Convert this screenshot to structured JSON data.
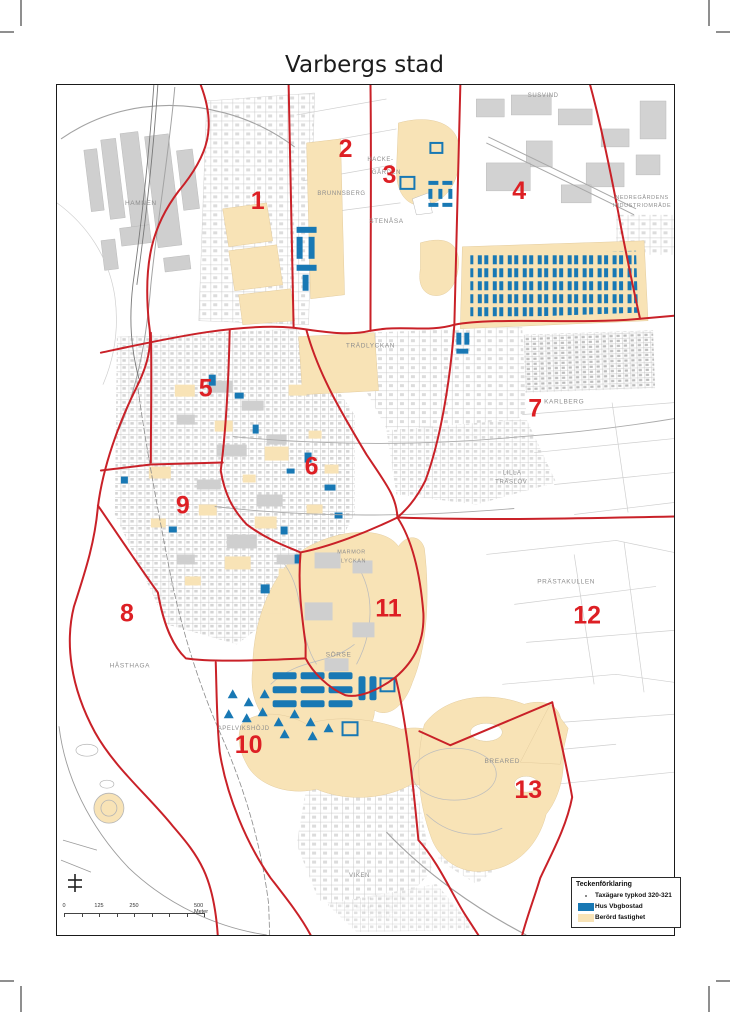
{
  "title": "Varbergs stad",
  "legend": {
    "title": "Teckenförklaring",
    "items": [
      {
        "label": "Taxägare typkod 320-321",
        "symbol": "dot"
      },
      {
        "label": "Hus Vbgbostad",
        "symbol": "blue"
      },
      {
        "label": "Berörd fastighet",
        "symbol": "beige"
      }
    ]
  },
  "scale_bar": {
    "labels": [
      {
        "text": "0",
        "x": 0
      },
      {
        "text": "125",
        "x": 35
      },
      {
        "text": "250",
        "x": 70
      },
      {
        "text": "500 Meter",
        "x": 140
      }
    ]
  },
  "districts": [
    {
      "label": "1",
      "x": 201,
      "y": 124
    },
    {
      "label": "2",
      "x": 289,
      "y": 72
    },
    {
      "label": "3",
      "x": 333,
      "y": 98
    },
    {
      "label": "4",
      "x": 463,
      "y": 114
    },
    {
      "label": "5",
      "x": 149,
      "y": 312
    },
    {
      "label": "6",
      "x": 255,
      "y": 390
    },
    {
      "label": "7",
      "x": 479,
      "y": 332
    },
    {
      "label": "8",
      "x": 70,
      "y": 537
    },
    {
      "label": "9",
      "x": 126,
      "y": 429
    },
    {
      "label": "10",
      "x": 192,
      "y": 669
    },
    {
      "label": "11",
      "x": 332,
      "y": 532
    },
    {
      "label": "12",
      "x": 531,
      "y": 539
    },
    {
      "label": "13",
      "x": 472,
      "y": 714
    }
  ],
  "place_labels": [
    {
      "text": "HAMNEN",
      "x": 84,
      "y": 120,
      "size": 6.5
    },
    {
      "text": "SUSVIND",
      "x": 487,
      "y": 12,
      "size": 6
    },
    {
      "text": "BRUNNSBERG",
      "x": 285,
      "y": 110,
      "size": 6
    },
    {
      "text": "HACKE-",
      "x": 324,
      "y": 76,
      "size": 6
    },
    {
      "text": "GÅRDEN",
      "x": 330,
      "y": 89,
      "size": 6
    },
    {
      "text": "STENÅSA",
      "x": 330,
      "y": 138,
      "size": 6.5
    },
    {
      "text": "NEDREGÅRDENS",
      "x": 586,
      "y": 114,
      "size": 5.5
    },
    {
      "text": "INDUSTRIOMRÅDE",
      "x": 586,
      "y": 122,
      "size": 5.5
    },
    {
      "text": "TRÄDLYCKAN",
      "x": 314,
      "y": 263,
      "size": 6.5
    },
    {
      "text": "KARLBERG",
      "x": 508,
      "y": 319,
      "size": 6.5
    },
    {
      "text": "LILLA",
      "x": 456,
      "y": 390,
      "size": 6
    },
    {
      "text": "TRÄSLÖV",
      "x": 455,
      "y": 399,
      "size": 6
    },
    {
      "text": "PRÄSTAKULLEN",
      "x": 510,
      "y": 499,
      "size": 6.5
    },
    {
      "text": "MARMOR",
      "x": 295,
      "y": 469,
      "size": 5.5
    },
    {
      "text": "LYCKAN",
      "x": 297,
      "y": 478,
      "size": 5.5
    },
    {
      "text": "SÖRSE",
      "x": 282,
      "y": 572,
      "size": 6.5
    },
    {
      "text": "HÅSTHAGA",
      "x": 73,
      "y": 583,
      "size": 6.5
    },
    {
      "text": "APELVIKSHÖJD",
      "x": 187,
      "y": 646,
      "size": 6
    },
    {
      "text": "BREARED",
      "x": 446,
      "y": 679,
      "size": 6.5
    },
    {
      "text": "VIKEN",
      "x": 303,
      "y": 793,
      "size": 6
    }
  ],
  "colors": {
    "boundary_line": "#c92128",
    "district_number": "#dd1f24",
    "hus_vbgbostad": "#1878b4",
    "berord_fastighet": "#f8e3b6"
  }
}
